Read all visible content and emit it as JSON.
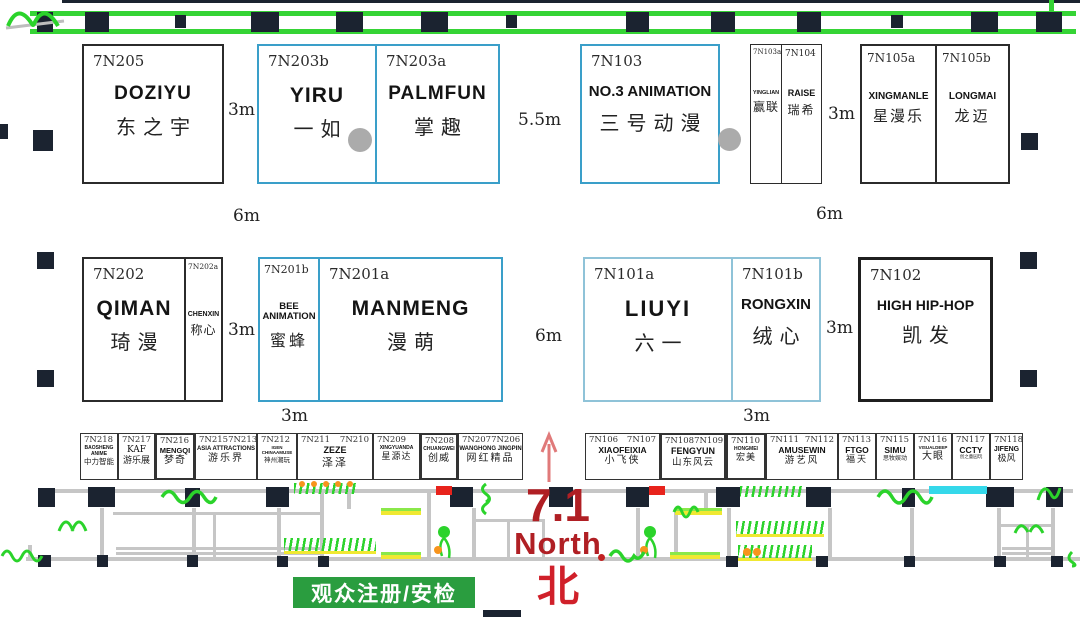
{
  "labels": {
    "registration": "观众注册/安检",
    "hall_number": "7.1",
    "north_en": "North",
    "north_zh": "北"
  },
  "dims": [
    "3m",
    "5.5m",
    "3m",
    "6m",
    "6m",
    "3m",
    "6m",
    "3m",
    "3m",
    "3m"
  ],
  "booths_top": [
    {
      "id": "7N205",
      "name_en": "DOZIYU",
      "name_zh": "东之宇"
    },
    {
      "id": "7N203b",
      "name_en": "YIRU",
      "name_zh": "一如"
    },
    {
      "id": "7N203a",
      "name_en": "PALMFUN",
      "name_zh": "掌趣"
    },
    {
      "id": "7N103",
      "name_en": "NO.3 ANIMATION",
      "name_zh": "三号动漫"
    },
    {
      "id": "7N103a",
      "name_en": "YINGLIAN",
      "name_zh": "赢联"
    },
    {
      "id": "7N104",
      "name_en": "RAISE",
      "name_zh": "瑞希"
    },
    {
      "id": "7N105a",
      "name_en": "XINGMANLE",
      "name_zh": "星漫乐"
    },
    {
      "id": "7N105b",
      "name_en": "LONGMAI",
      "name_zh": "龙迈"
    }
  ],
  "booths_mid": [
    {
      "id": "7N202",
      "name_en": "QIMAN",
      "name_zh": "琦漫"
    },
    {
      "id": "7N202a",
      "name_en": "CHENXIN",
      "name_zh": "称心"
    },
    {
      "id": "7N201b",
      "name_en": "BEE ANIMATION",
      "name_zh": "蜜蜂"
    },
    {
      "id": "7N201a",
      "name_en": "MANMENG",
      "name_zh": "漫萌"
    },
    {
      "id": "7N101a",
      "name_en": "LIUYI",
      "name_zh": "六一"
    },
    {
      "id": "7N101b",
      "name_en": "RONGXIN",
      "name_zh": "绒心"
    },
    {
      "id": "7N102",
      "name_en": "HIGH HIP-HOP",
      "name_zh": "凯发"
    }
  ],
  "booths_small_left": [
    {
      "id": "7N218",
      "name_en": "BAOSHENG ANIME",
      "name_zh": "中力智能"
    },
    {
      "id": "7N217",
      "name_en": "KAF",
      "name_zh": "游乐展"
    },
    {
      "id": "7N216",
      "name_en": "MENGQI",
      "name_zh": "梦奇"
    },
    {
      "id": "7N215",
      "id2": "7N213",
      "name_en": "ASIA ATTRACTIONS",
      "name_zh": "游乐界"
    },
    {
      "id": "7N212",
      "name_en": "IGEN CHINAAMUSE",
      "name_zh": "神州潮玩"
    },
    {
      "id": "7N211",
      "id2": "7N210",
      "name_en": "ZEZE",
      "name_zh": "泽泽"
    },
    {
      "id": "7N209",
      "name_en": "XINGYUANDA",
      "name_zh": "星源达"
    },
    {
      "id": "7N208",
      "name_en": "CHUANGWEI",
      "name_zh": "创威"
    },
    {
      "id": "7N207",
      "id2": "7N206",
      "name_en": "WANGHONG JINGPIN",
      "name_zh": "网红精品"
    }
  ],
  "booths_small_right": [
    {
      "id": "7N106",
      "id2": "7N107",
      "name_en": "XIAOFEIXIA",
      "name_zh": "小飞侠"
    },
    {
      "id": "7N108",
      "id2": "7N109",
      "name_en": "FENGYUN",
      "name_zh": "山东风云"
    },
    {
      "id": "7N110",
      "name_en": "HONGMEI",
      "name_zh": "宏美"
    },
    {
      "id": "7N111",
      "id2": "7N112",
      "name_en": "AMUSEWIN",
      "name_zh": "游艺风"
    },
    {
      "id": "7N113",
      "name_en": "FTGO",
      "name_zh": "福天"
    },
    {
      "id": "7N115",
      "name_en": "SIMU",
      "name_zh": "思牧娱动"
    },
    {
      "id": "7N116",
      "name_en": "VISUALDEEP",
      "name_zh": "大眼"
    },
    {
      "id": "7N117",
      "name_en": "CCTY",
      "name_zh": "创之童园玩"
    },
    {
      "id": "7N118",
      "name_en": "JIFENG",
      "name_zh": "极风"
    }
  ],
  "colors": {
    "booth_black_border": "#2b2b2b",
    "booth_blue_border": "#3a9fc9",
    "wall_green": "#35d435",
    "registration_green": "#2a9d3f",
    "red_text": "#b01f24",
    "cyan_strip": "#35d8ea",
    "pillar": "#1b2330",
    "corridor_gray": "#c6c6c6"
  }
}
